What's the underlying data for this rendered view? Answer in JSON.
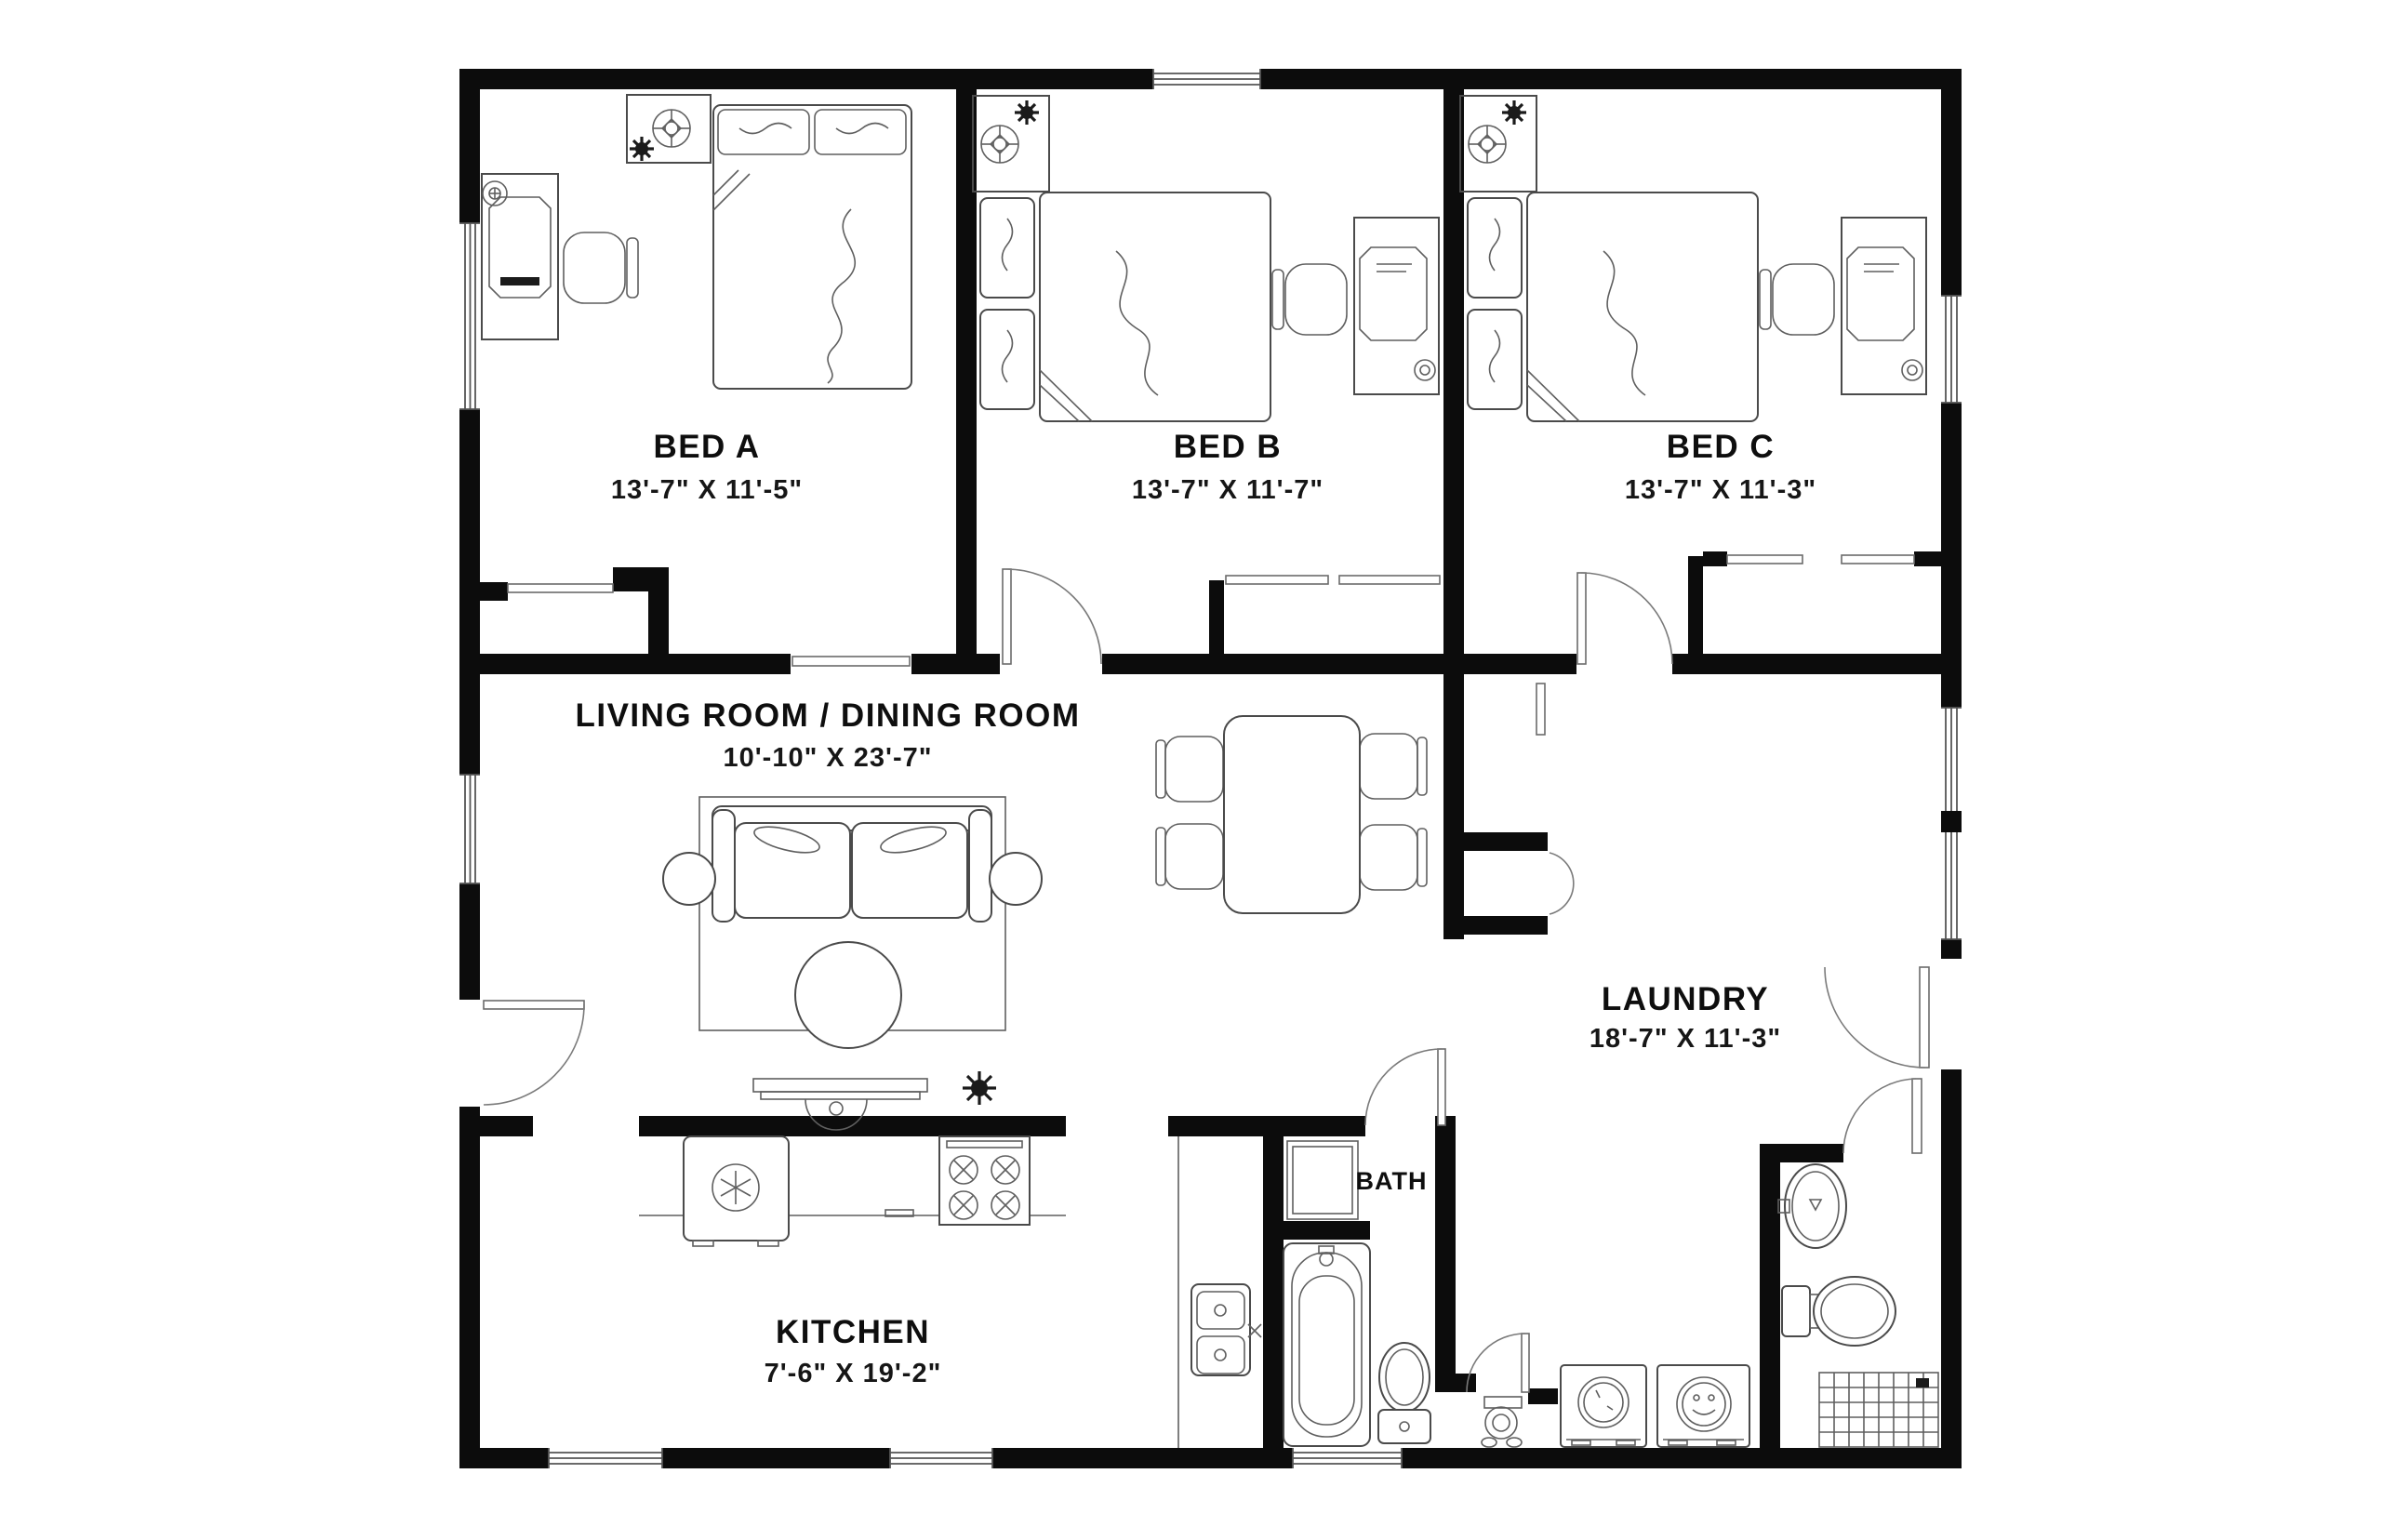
{
  "canvas": {
    "background": "#ffffff",
    "wall_color": "#0c0c0c",
    "line_color": "#4a4a4a",
    "text_color": "#0e0e0e"
  },
  "rooms": {
    "bed_a": {
      "name": "BED A",
      "dims": "13'-7\" X 11'-5\"",
      "furniture": [
        "bed",
        "pillows",
        "nightstand",
        "ceiling-fan",
        "plant",
        "media-cabinet",
        "tv",
        "chair",
        "lamp",
        "closet"
      ]
    },
    "bed_b": {
      "name": "BED B",
      "dims": "13'-7\" X 11'-7\"",
      "furniture": [
        "bed",
        "pillows",
        "nightstand",
        "ceiling-fan",
        "plant",
        "desk",
        "tv",
        "chair",
        "mug",
        "closet"
      ]
    },
    "bed_c": {
      "name": "BED C",
      "dims": "13'-7\" X 11'-3\"",
      "furniture": [
        "bed",
        "pillows",
        "nightstand",
        "ceiling-fan",
        "plant",
        "desk",
        "tv",
        "chair",
        "mug",
        "closet"
      ]
    },
    "living": {
      "name": "LIVING ROOM / DINING ROOM",
      "dims": "10'-10\" X 23'-7\"",
      "furniture": [
        "sofa",
        "throw-pillows",
        "side-table",
        "side-table",
        "ottoman",
        "area-rug",
        "console-table",
        "plant",
        "dining-table",
        "dining-chairs"
      ]
    },
    "laundry": {
      "name": "LAUNDRY",
      "dims": "18'-7\" X 11'-3\"",
      "furniture": [
        "washer",
        "dryer",
        "closet",
        "pedestal-sink"
      ]
    },
    "kitchen": {
      "name": "KITCHEN",
      "dims": "7'-6\" X 19'-2\"",
      "furniture": [
        "refrigerator",
        "range",
        "counter",
        "double-sink"
      ]
    },
    "bath": {
      "name": "BATH",
      "furniture": [
        "linen-shower-stall",
        "bathtub",
        "toilet"
      ]
    },
    "laundry_bath": {
      "furniture": [
        "oval-sink",
        "toilet",
        "tiled-shower"
      ]
    }
  }
}
